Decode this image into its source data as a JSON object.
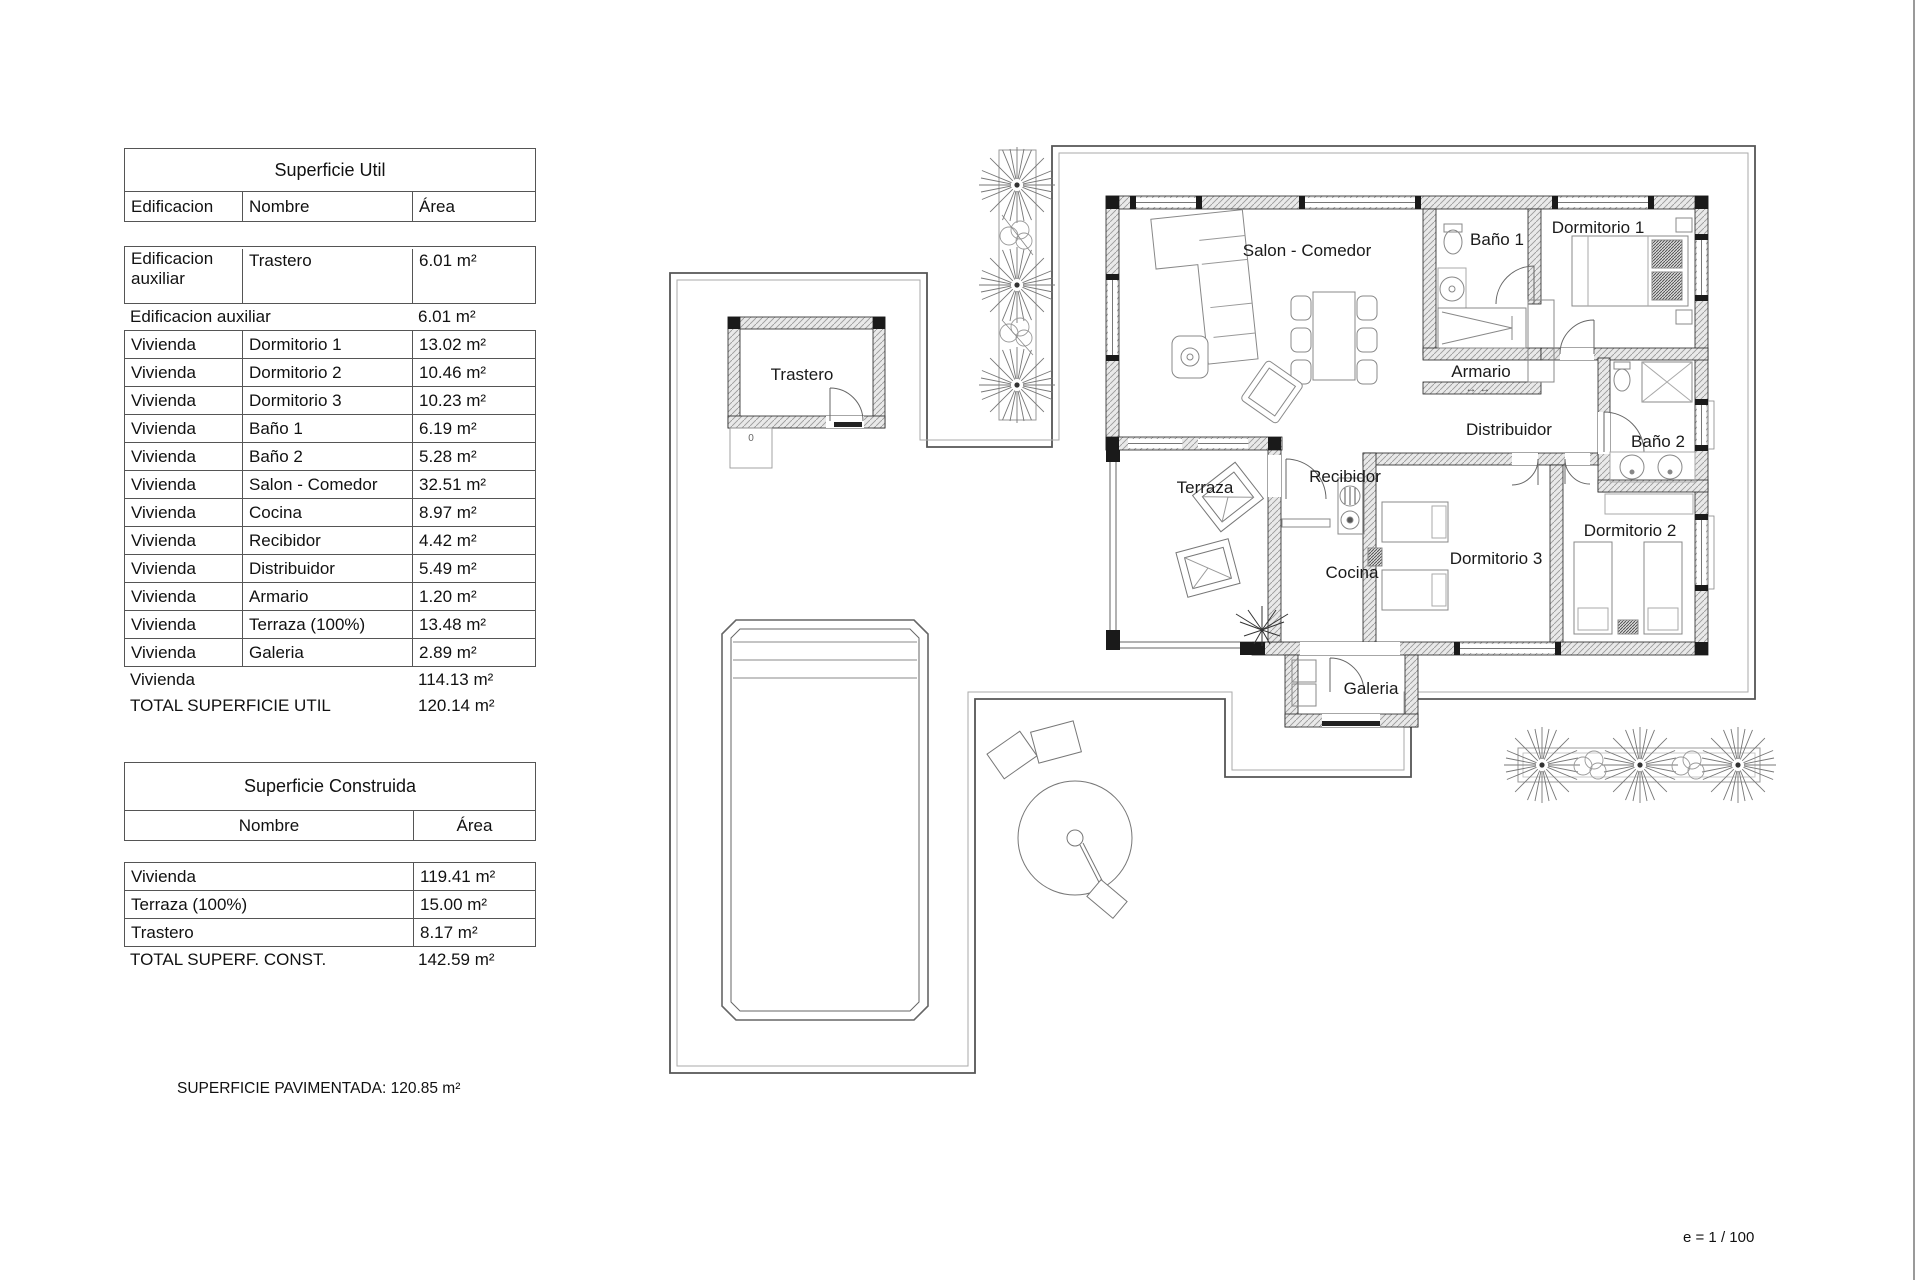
{
  "tables": {
    "util": {
      "title": "Superficie Util",
      "headers": {
        "building": "Edificacion",
        "name": "Nombre",
        "area": "Área"
      },
      "aux_row": {
        "building": "Edificacion auxiliar",
        "name": "Trastero",
        "area": "6.01 m²"
      },
      "aux_total": {
        "label": "Edificacion auxiliar",
        "area": "6.01 m²"
      },
      "rows": [
        {
          "building": "Vivienda",
          "name": "Dormitorio 1",
          "area": "13.02 m²"
        },
        {
          "building": "Vivienda",
          "name": "Dormitorio 2",
          "area": "10.46 m²"
        },
        {
          "building": "Vivienda",
          "name": "Dormitorio 3",
          "area": "10.23 m²"
        },
        {
          "building": "Vivienda",
          "name": "Baño 1",
          "area": "6.19 m²"
        },
        {
          "building": "Vivienda",
          "name": "Baño 2",
          "area": "5.28 m²"
        },
        {
          "building": "Vivienda",
          "name": "Salon - Comedor",
          "area": "32.51 m²"
        },
        {
          "building": "Vivienda",
          "name": "Cocina",
          "area": "8.97 m²"
        },
        {
          "building": "Vivienda",
          "name": "Recibidor",
          "area": "4.42 m²"
        },
        {
          "building": "Vivienda",
          "name": "Distribuidor",
          "area": "5.49 m²"
        },
        {
          "building": "Vivienda",
          "name": "Armario",
          "area": "1.20 m²"
        },
        {
          "building": "Vivienda",
          "name": "Terraza (100%)",
          "area": "13.48 m²"
        },
        {
          "building": "Vivienda",
          "name": "Galeria",
          "area": "2.89 m²"
        }
      ],
      "vivienda_total": {
        "label": "Vivienda",
        "area": "114.13 m²"
      },
      "grand_total": {
        "label": "TOTAL SUPERFICIE UTIL",
        "area": "120.14 m²"
      }
    },
    "construida": {
      "title": "Superficie Construida",
      "headers": {
        "name": "Nombre",
        "area": "Área"
      },
      "rows": [
        {
          "name": "Vivienda",
          "area": "119.41 m²"
        },
        {
          "name": "Terraza (100%)",
          "area": "15.00 m²"
        },
        {
          "name": "Trastero",
          "area": "8.17 m²"
        }
      ],
      "total": {
        "label": "TOTAL SUPERF. CONST.",
        "area": "142.59 m²"
      }
    }
  },
  "footer": {
    "paved_note": "SUPERFICIE PAVIMENTADA: 120.85 m²"
  },
  "scale_note": "e = 1 / 100",
  "plan": {
    "labels": {
      "trastero": "Trastero",
      "terraza": "Terraza",
      "salon": "Salon - Comedor",
      "bano1": "Baño 1",
      "dorm1": "Dormitorio 1",
      "armario": "Armario",
      "armario_arrows": "↔    ↔",
      "distribuidor": "Distribuidor",
      "bano2": "Baño 2",
      "recibidor": "Recibidor",
      "cocina": "Cocina",
      "dorm3": "Dormitorio 3",
      "dorm2": "Dormitorio 2",
      "galeria": "Galeria",
      "pad_zero": "0"
    }
  }
}
